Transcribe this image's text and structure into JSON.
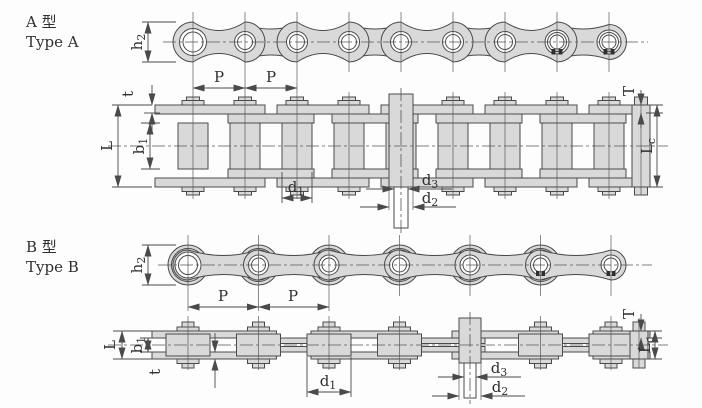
{
  "colors": {
    "plate_fill": "#d9d9d9",
    "line": "#4a4a4a",
    "text": "#2f2f2f",
    "background": "#fdfdfd"
  },
  "type_a": {
    "title_cn": "A 型",
    "title_en": "Type A",
    "side_view": {
      "h2_base": "h",
      "h2_sub": "2",
      "p1": "P",
      "p2": "P"
    },
    "section_view": {
      "t": "t",
      "L": "L",
      "b1_base": "b",
      "b1_sub": "1",
      "d1_base": "d",
      "d1_sub": "1",
      "d3_base": "d",
      "d3_sub": "3",
      "d2_base": "d",
      "d2_sub": "2",
      "T": "T",
      "Lc_base": "L",
      "Lc_sub": "c"
    }
  },
  "type_b": {
    "title_cn": "B 型",
    "title_en": "Type B",
    "side_view": {
      "h2_base": "h",
      "h2_sub": "2",
      "p1": "P",
      "p2": "P"
    },
    "section_view": {
      "t": "t",
      "L": "L",
      "b1_base": "b",
      "b1_sub": "1",
      "d1_base": "d",
      "d1_sub": "1",
      "d3_base": "d",
      "d3_sub": "3",
      "d2_base": "d",
      "d2_sub": "2",
      "T": "T",
      "Lc_base": "L",
      "Lc_sub": "c"
    }
  }
}
